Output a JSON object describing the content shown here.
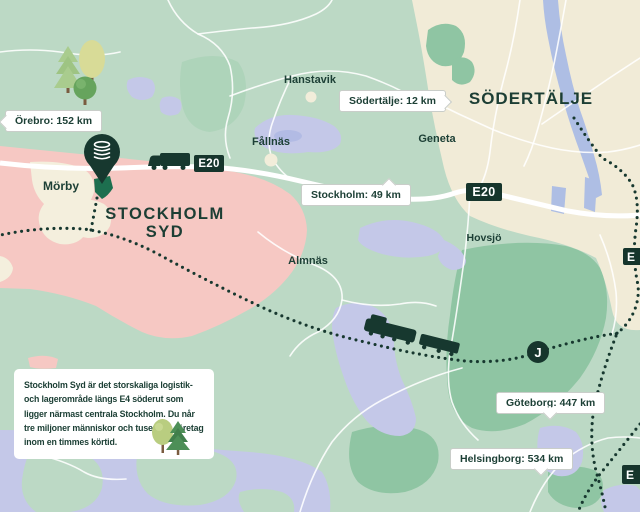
{
  "titles": {
    "sodertalje": "SÖDERTÄLJE",
    "stockholm_syd_line1": "STOCKHOLM",
    "stockholm_syd_line2": "SYD"
  },
  "places": {
    "hanstavik": "Hanstavik",
    "fallnas": "Fållnäs",
    "geneta": "Geneta",
    "morby": "Mörby",
    "hovsjo": "Hovsjö",
    "almnas": "Almnäs"
  },
  "callouts": {
    "orebro": {
      "text": "Örebro: 152 km"
    },
    "sodertalje": {
      "text": "Södertälje: 12 km"
    },
    "stockholm": {
      "text": "Stockholm: 49 km"
    },
    "goteborg": {
      "text": "Göteborg: 447 km"
    },
    "helsingborg": {
      "text": "Helsingborg: 534 km"
    }
  },
  "badges": {
    "e20_west": "E20",
    "e20_east": "E20",
    "e_edge_mid": "E",
    "e_edge_bottom": "E",
    "rail_station": "J"
  },
  "info_box": {
    "text": "Stockholm Syd är det storskaliga logistik- och lagerområde längs E4 söderut som ligger närmast centrala Stockholm. Du når tre miljoner människor och tusentals företag inom en timmes körtid."
  },
  "icons": {
    "location_pin": "brand-location-pin",
    "truck": "freight-truck",
    "train": "freight-train",
    "station": "commuter-rail-J",
    "trees": "decorative-trees"
  },
  "colors": {
    "background_green": "#bcd9c5",
    "forest_green": "#8fc5a3",
    "urban_beige": "#f1ebd7",
    "district_pink": "#f6c8c3",
    "village_cream": "#f4efdd",
    "water_lavender": "#c4c8e8",
    "river_blue": "#aebee4",
    "road_white": "#ffffff",
    "brand_dark_green": "#1d4036",
    "badge_green": "#16352c",
    "plot_green": "#1d6f4f"
  }
}
